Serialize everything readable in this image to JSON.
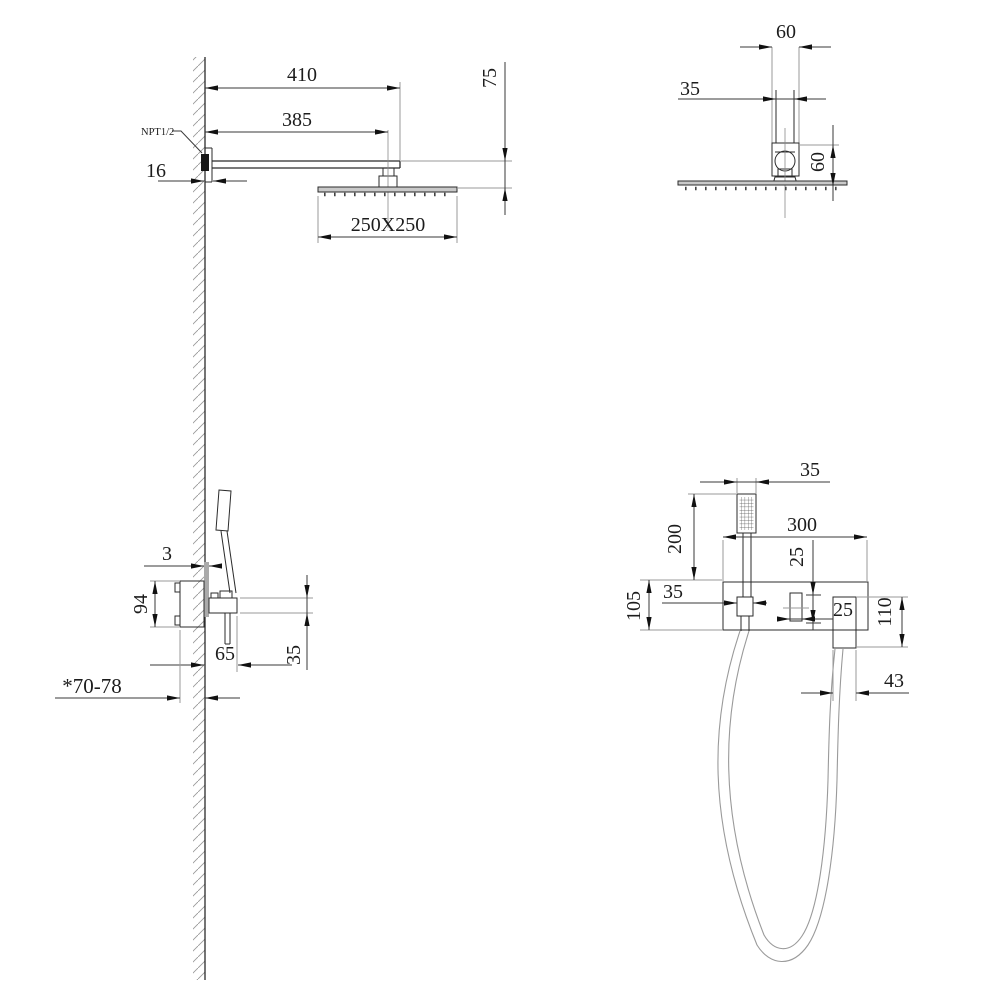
{
  "colors": {
    "line": "#2b2b2b",
    "dimension": "#3a3a3a",
    "extension": "#9a9a9a",
    "plate_fill": "#c9c9c9",
    "wall_plate_fill": "#aaaaaa"
  },
  "labels": {
    "side_view": {
      "arm_length": "410",
      "arm_to_center": "385",
      "drop_height": "75",
      "thread": "NPT1/2",
      "wall_offset": "16",
      "head_size": "250X250"
    },
    "end_view": {
      "bracket_width": "60",
      "arm_width": "35",
      "bracket_height": "60"
    },
    "valve_side_view": {
      "plate_thickness": "3",
      "body_height": "94",
      "trim_depth": "65",
      "trim_height": "35",
      "rough_in_depth": "*70-78"
    },
    "valve_front_view": {
      "handshower_width": "35",
      "handshower_height": "200",
      "plate_width": "300",
      "handle_top_offset": "25",
      "plate_height": "105",
      "holder_width": "35",
      "handle_width": "25",
      "outlet_height": "110",
      "outlet_width": "43"
    }
  }
}
